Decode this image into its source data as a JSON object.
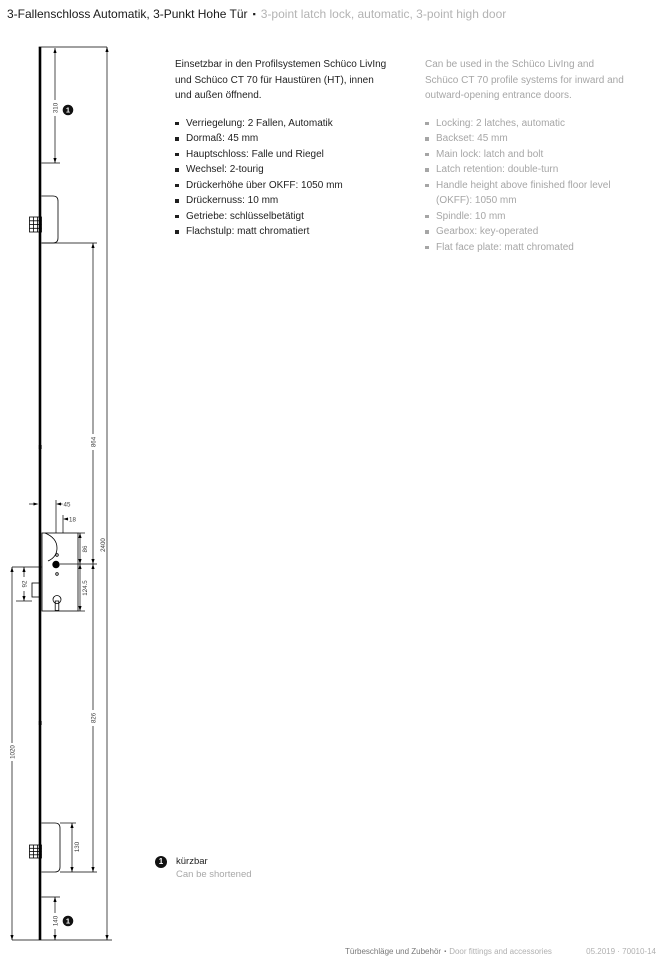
{
  "title": {
    "de": "3-Fallenschloss Automatik, 3-Punkt Hohe Tür",
    "sep": "▪",
    "en": "3-point latch lock, automatic, 3-point high door"
  },
  "description_de": {
    "intro": "Einsetzbar in den Profilsystemen Schüco LivIng\nund Schüco CT 70 für Haustüren (HT), innen\nund außen öffnend.",
    "bullets": [
      "Verriegelung: 2 Fallen, Automatik",
      "Dormaß: 45 mm",
      "Hauptschloss: Falle und Riegel",
      "Wechsel: 2-tourig",
      "Drückerhöhe über OKFF: 1050 mm",
      "Drückernuss: 10 mm",
      "Getriebe: schlüsselbetätigt",
      "Flachstulp: matt chromatiert"
    ]
  },
  "description_en": {
    "intro": "Can be used in the Schüco LivIng and\nSchüco CT 70 profile systems for inward and\noutward-opening entrance doors.",
    "bullets": [
      "Locking: 2 latches, automatic",
      "Backset: 45 mm",
      "Main lock: latch and bolt",
      "Latch retention: double-turn",
      "Handle height above finished floor level\n(OKFF): 1050 mm",
      "Spindle: 10 mm",
      "Gearbox: key-operated",
      "Flat face plate: matt chromated"
    ]
  },
  "drawing": {
    "marker": "1",
    "dims": {
      "top_shorten": "310",
      "total_height": "2400",
      "upper_spacing": "864",
      "lower_spacing": "826",
      "spindle_to_bottom": "1020",
      "backset": "45",
      "nut_offset": "18",
      "case_top_to_spindle": "86",
      "spindle_to_case_bottom": "124.5",
      "spindle_to_cylinder": "92",
      "bottom_latch_height": "130",
      "bottom_shorten": "140"
    }
  },
  "footnote": {
    "marker": "1",
    "de": "kürzbar",
    "en": "Can be shortened"
  },
  "footer": {
    "section_de": "Türbeschläge und Zubehör",
    "sep": "▪",
    "section_en": "Door fittings and accessories",
    "right_ref": "05.2019 · 70010-14"
  }
}
